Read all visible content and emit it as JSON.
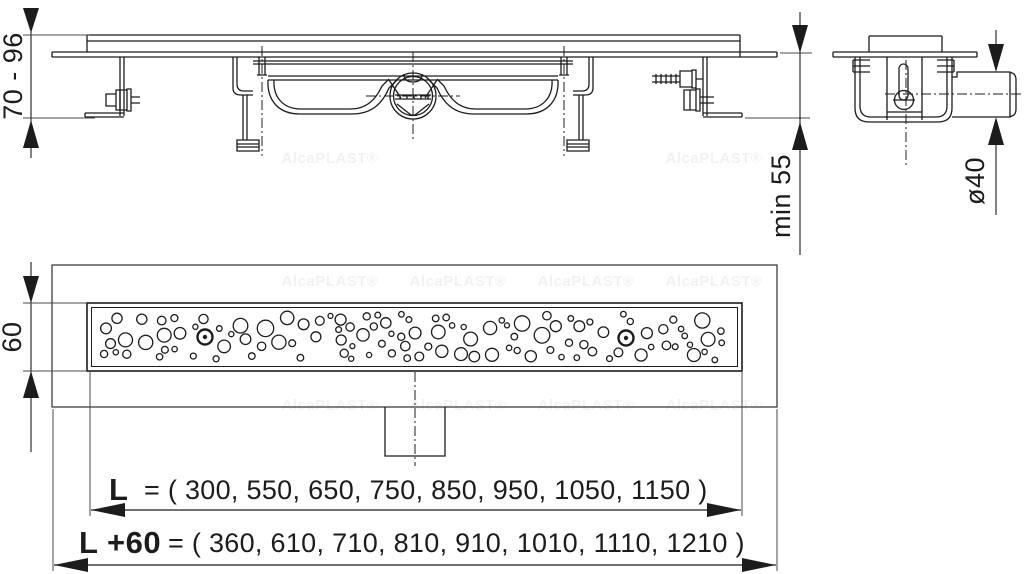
{
  "meta": {
    "background": "#ffffff",
    "line_color": "#1c1c1c",
    "ext_line_color": "#4a4a4a"
  },
  "watermark": {
    "text": "AlcaPLAST®",
    "opacity": 0.055,
    "positions": [
      [
        330,
        163
      ],
      [
        714,
        163
      ],
      [
        330,
        286
      ],
      [
        458,
        286
      ],
      [
        586,
        286
      ],
      [
        714,
        286
      ],
      [
        330,
        410
      ],
      [
        458,
        410
      ],
      [
        586,
        410
      ],
      [
        714,
        410
      ]
    ]
  },
  "dimensions": {
    "installation_height": "70 - 96",
    "min_installation_depth": "min 55",
    "outlet_pipe_diameter": "ø40",
    "channel_width": "60",
    "length_L": {
      "label": "L",
      "rest": "= ( 300, 550, 650, 750, 850, 950, 1050, 1150 )",
      "values": [
        300,
        550,
        650,
        750,
        850,
        950,
        1050,
        1150
      ]
    },
    "length_L_plus_60": {
      "label": "L +60",
      "rest": "= ( 360, 610, 710, 810, 910, 1010, 1110, 1210 )",
      "values": [
        360,
        610,
        710,
        810,
        910,
        1010,
        1110,
        1210
      ]
    }
  },
  "grate_pattern": {
    "style": "bubbles",
    "count": 112,
    "min_radius": 2.5,
    "max_radius": 8.2,
    "seed": 20231,
    "region": {
      "x": 96,
      "y": 311,
      "width": 636,
      "height": 52
    },
    "screws": [
      [
        205,
        337
      ],
      [
        626,
        338
      ]
    ]
  }
}
